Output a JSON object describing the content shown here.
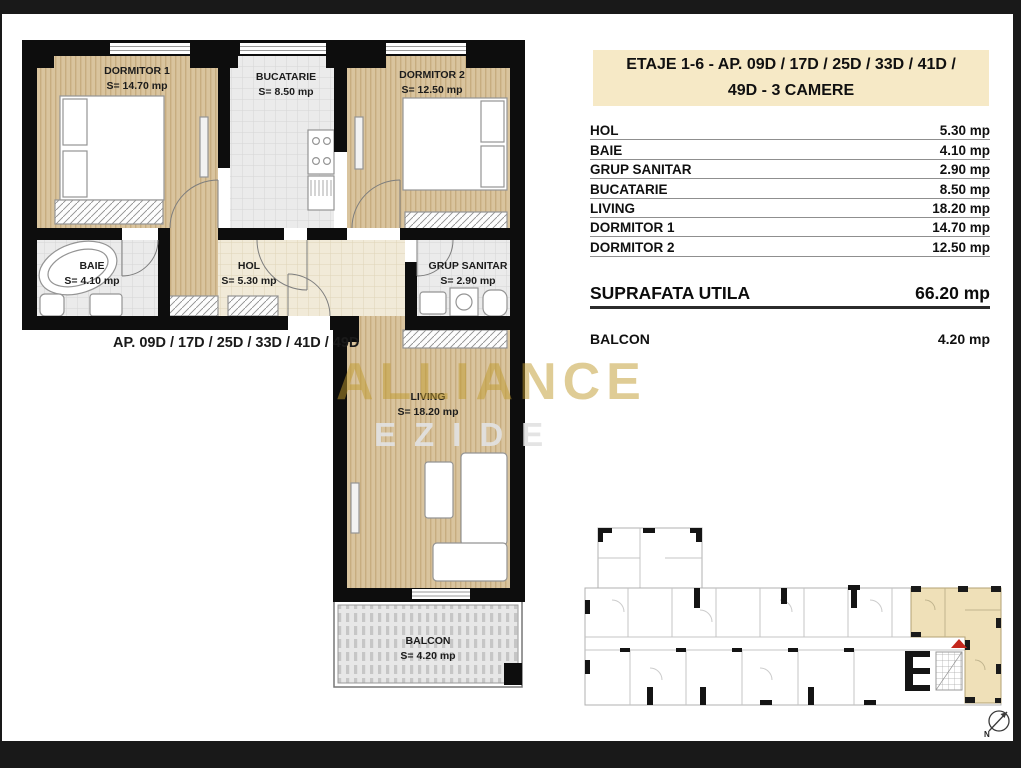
{
  "plan": {
    "rooms": [
      {
        "label": "DORMITOR 1",
        "area": "S= 14.70 mp"
      },
      {
        "label": "BUCATARIE",
        "area": "S= 8.50 mp"
      },
      {
        "label": "DORMITOR 2",
        "area": "S= 12.50 mp"
      },
      {
        "label": "BAIE",
        "area": "S= 4.10 mp"
      },
      {
        "label": "HOL",
        "area": "S= 5.30 mp"
      },
      {
        "label": "GRUP SANITAR",
        "area": "S= 2.90 mp"
      },
      {
        "label": "LIVING",
        "area": "S= 18.20 mp"
      },
      {
        "label": "BALCON",
        "area": "S= 4.20 mp"
      }
    ],
    "caption": "AP.  09D / 17D / 25D / 33D / 41D / 49D"
  },
  "panel": {
    "header_line1": "ETAJE 1-6 -  AP.  09D / 17D / 25D / 33D / 41D /",
    "header_line2": "49D   - 3 CAMERE",
    "rows": [
      {
        "label": "HOL",
        "value": "5.30 mp"
      },
      {
        "label": "BAIE",
        "value": "4.10 mp"
      },
      {
        "label": "GRUP SANITAR",
        "value": "2.90 mp"
      },
      {
        "label": "BUCATARIE",
        "value": "8.50 mp"
      },
      {
        "label": "LIVING",
        "value": "18.20 mp"
      },
      {
        "label": "DORMITOR 1",
        "value": "14.70 mp"
      },
      {
        "label": "DORMITOR 2",
        "value": "12.50 mp"
      }
    ],
    "total": {
      "label": "SUPRAFATA UTILA",
      "value": "66.20 mp"
    },
    "balcony": {
      "label": "BALCON",
      "value": "4.20 mp"
    }
  },
  "watermark": {
    "brand": "ALLIANCE",
    "tagline": "EZIDE"
  },
  "keyplan": {
    "north": "N",
    "highlight_color": "#efe0b8",
    "marker_color": "#c4271c"
  },
  "colors": {
    "wall": "#0d0d0d",
    "wood": "#d9c49e",
    "tile": "#ebebeb",
    "header_bg": "#f6e9c6",
    "gold": "#c19b2e"
  }
}
